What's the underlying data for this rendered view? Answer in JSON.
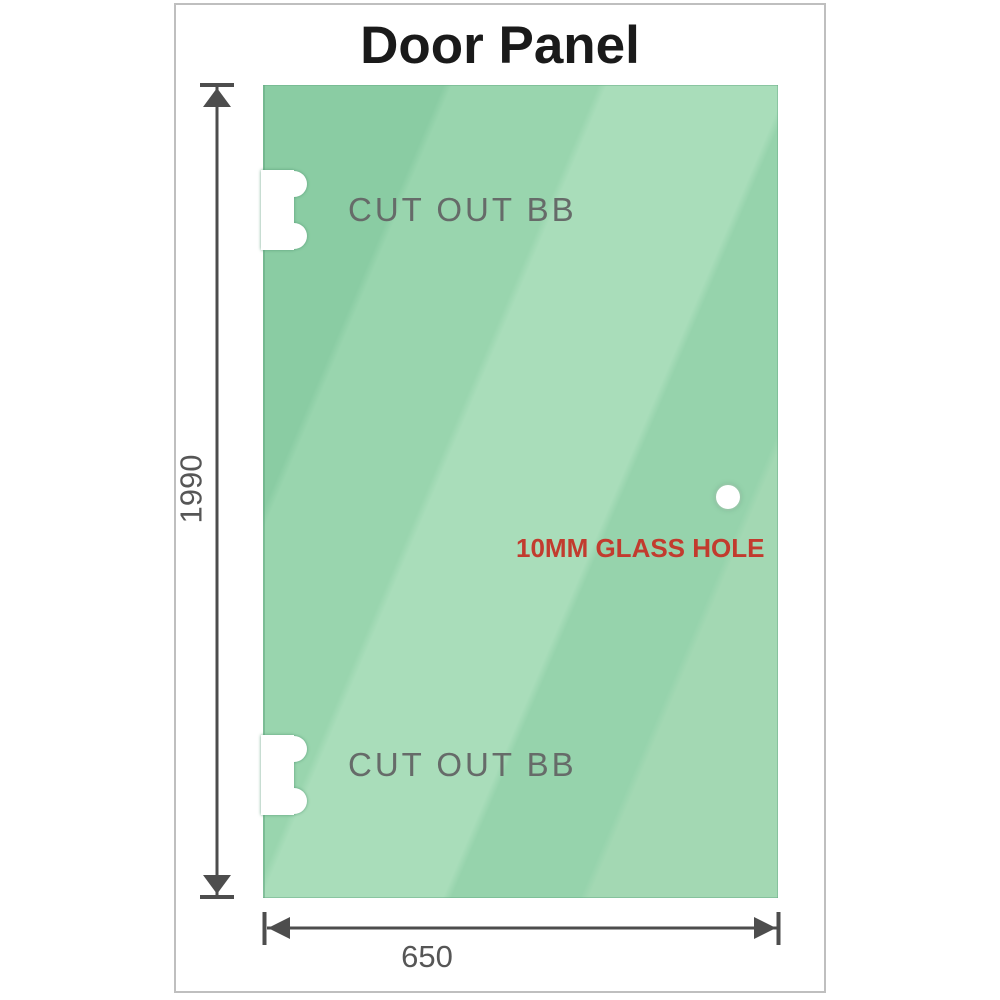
{
  "title": "Door Panel",
  "panel": {
    "cutouts": [
      {
        "label": "CUT OUT BB"
      },
      {
        "label": "CUT OUT BB"
      }
    ],
    "hole": {
      "label": "10MM GLASS HOLE"
    }
  },
  "dimensions": {
    "height": "1990",
    "width": "650"
  },
  "colors": {
    "glass_green_base": "#8acca3",
    "glass_green_highlight": "#a9ddba",
    "panel_edge_green": "#64a882",
    "dimension_gray": "#4d4d4d",
    "dimension_text_gray": "#565656",
    "cutout_text_gray": "#666b69",
    "hole_label_red": "#c23b2e",
    "title_black": "#1a1a1a",
    "frame_border_gray": "#bfbfbf"
  }
}
